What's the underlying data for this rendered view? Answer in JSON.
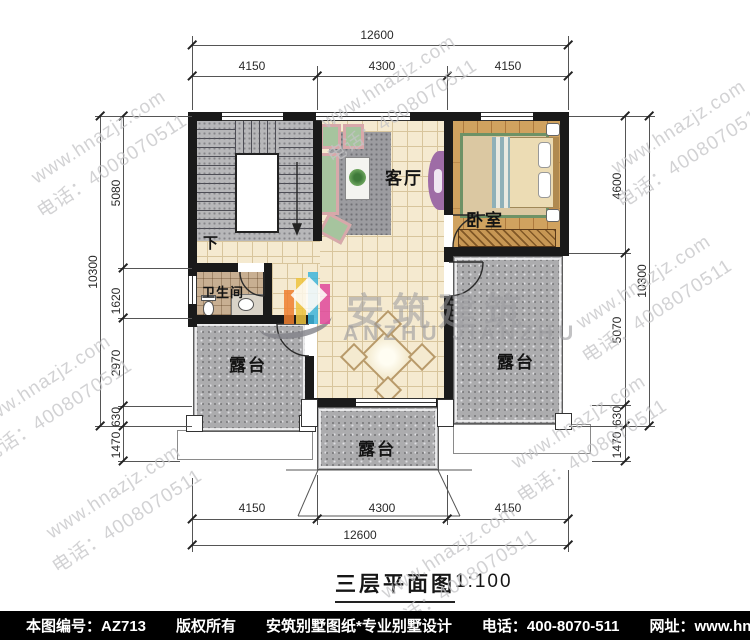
{
  "title": {
    "text": "三层平面图",
    "scale": "1:100"
  },
  "logo": {
    "cn": "安筑建筑",
    "en": "ANZHU JIANZHU"
  },
  "watermark": {
    "line1": "www.hnazjz.com",
    "line2": "电话：4008070511"
  },
  "footer": {
    "doc_no": "本图编号：AZ713",
    "copyright": "版权所有",
    "company": "安筑别墅图纸*专业别墅设计",
    "phone": "电话：400-8070-511",
    "website": "网址：www.hnazjz.com"
  },
  "rooms": {
    "living": "客厅",
    "bedroom": "卧室",
    "bathroom": "卫生间",
    "stairs_down": "下",
    "terrace_left": "露台",
    "terrace_right": "露台",
    "terrace_bottom": "露台"
  },
  "dimensions": {
    "top": {
      "total": "12600",
      "segments": [
        "4150",
        "4300",
        "4150"
      ]
    },
    "bottom": {
      "total": "12600",
      "segments": [
        "4150",
        "4300",
        "4150"
      ]
    },
    "left": {
      "total": "10300",
      "segments": [
        "5080",
        "1620",
        "2970",
        "630",
        "1470"
      ]
    },
    "right": {
      "total": "10300",
      "segments": [
        "4600",
        "5070",
        "630",
        "1470"
      ]
    }
  },
  "colors": {
    "wall": "#1a1a1a",
    "tile": "#f5ead0",
    "tile_line": "#d8c59c",
    "wood": "#d0a25f",
    "stair": "#b7b7b9",
    "terrace": "#acacae",
    "bath": "#c8af92",
    "rug": "#9c9ca0",
    "sofa_green": "#a6c49e",
    "sofa_trim": "#d8a8aa",
    "accent_purple": "#9e6ca6",
    "rug_border": "#6e9266",
    "bed": "#ecdcb4",
    "wardrobe": "#c79754",
    "dim": "#2a2a2a",
    "watermark_color": "#c4c4c6",
    "logo_gray": "#9a9a9e",
    "footer_bg": "#000000",
    "footer_fg": "#ffffff"
  }
}
